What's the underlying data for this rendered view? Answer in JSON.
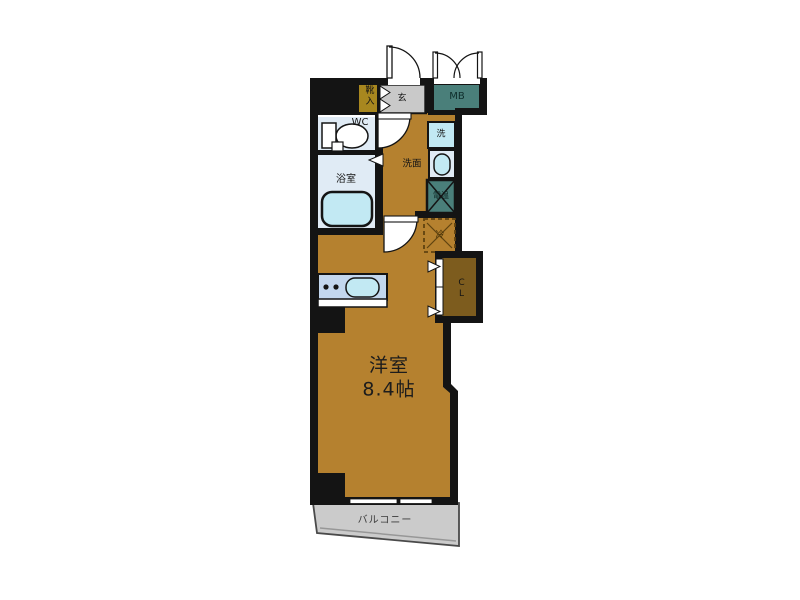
{
  "floorplan": {
    "unit_labels": {
      "shoe_cabinet": "靴入",
      "entrance": "玄",
      "meter_box": "MB",
      "toilet": "WC",
      "bathroom": "浴室",
      "washing_machine": "洗",
      "washroom": "洗面",
      "water_heater": "電温",
      "refrigerator": "冷",
      "closet": "CL",
      "main_room_name": "洋室",
      "main_room_size": "8.4帖",
      "balcony": "バルコニー"
    },
    "colors": {
      "wall": "#141414",
      "floor": "#b5812f",
      "closet_floor": "#7d5c1e",
      "shoe_cabinet": "#a8871f",
      "meter_box": "#4a7f7a",
      "water_heater": "#4a7f7a",
      "wet_room": "#e0ebf5",
      "fixture": "#c2e9f3",
      "kitchen_counter": "#c3d7ee",
      "entrance_floor": "#c9c9c9",
      "balcony": "#cbcbcb"
    }
  }
}
